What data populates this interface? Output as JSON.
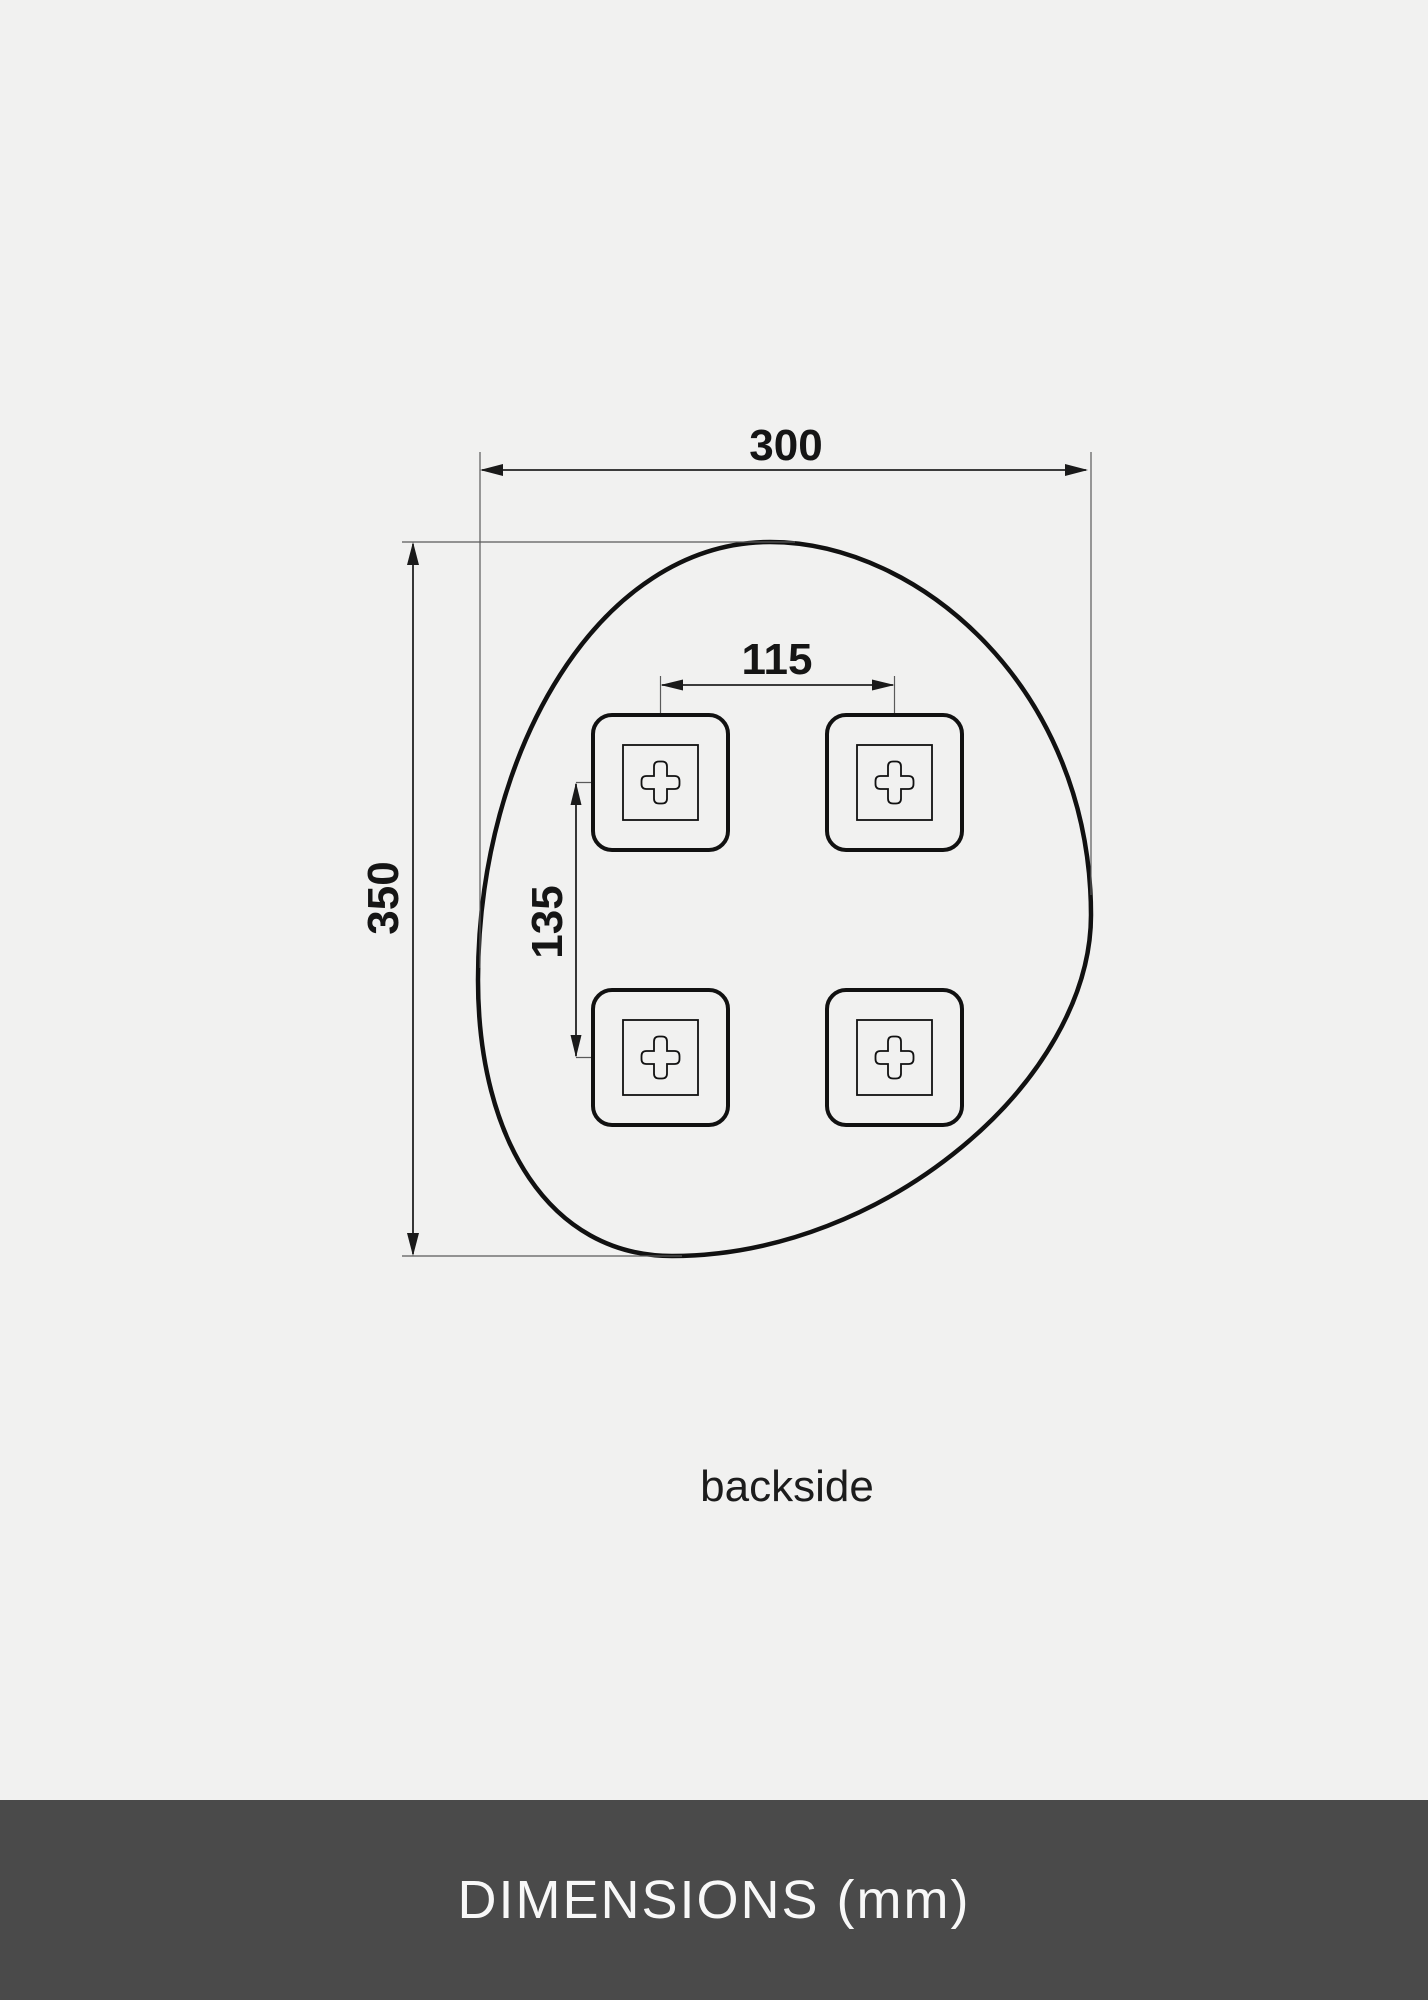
{
  "colors": {
    "page_background": "#f1f1f0",
    "outline": "#111111",
    "dimension_line": "#222222",
    "extension_line": "#5a5a5a",
    "text": "#151515",
    "footer_background": "#4a4a4a",
    "footer_text": "#f8f8f8"
  },
  "drawing": {
    "width_mm": "300",
    "height_mm": "350",
    "bracket_spacing_horizontal_mm": "115",
    "bracket_spacing_vertical_mm": "135",
    "view_label": "backside"
  },
  "footer": {
    "title": "DIMENSIONS (mm)"
  }
}
